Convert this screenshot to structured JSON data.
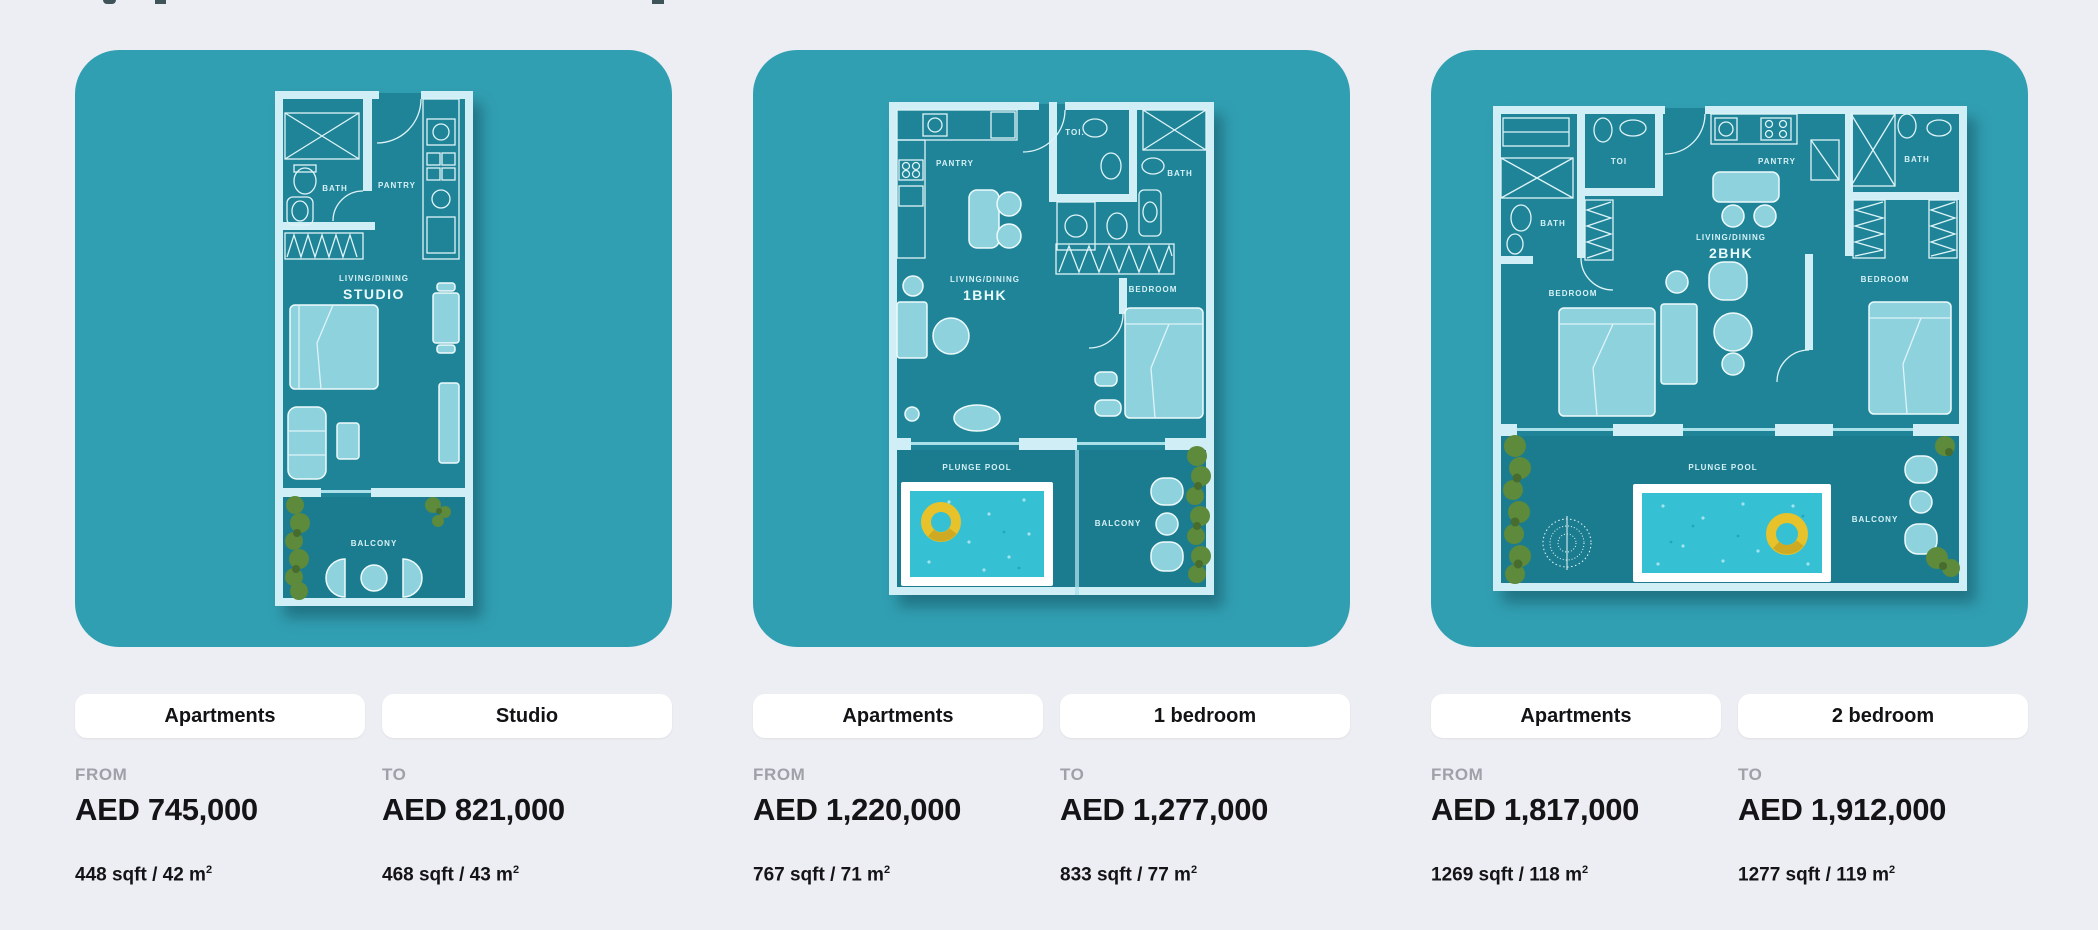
{
  "colors": {
    "page_bg": "#edeef3",
    "panel_teal": "#319fb2",
    "plan_interior": "#1f8498",
    "wall_light": "#cfeef6",
    "furniture_teal": "#8ed2de",
    "pool_water": "#35c0d4",
    "pool_frame": "#ffffff",
    "swim_ring_yellow": "#e8c22a",
    "hedge_green": "#5d8a3b",
    "pill_bg": "#ffffff",
    "label_gray": "#9fa0a8",
    "text_dark": "#141417"
  },
  "cards": [
    {
      "category": "Apartments",
      "bedrooms": "Studio",
      "from": {
        "label": "FROM",
        "price": "AED 745,000",
        "area": "448 sqft / 42 m",
        "area_sup": "2"
      },
      "to": {
        "label": "TO",
        "price": "AED 821,000",
        "area": "468 sqft / 43 m",
        "area_sup": "2"
      },
      "plan": {
        "bath": "BATH",
        "pantry": "PANTRY",
        "living": "LIVING/DINING",
        "unit": "STUDIO",
        "balcony": "BALCONY"
      }
    },
    {
      "category": "Apartments",
      "bedrooms": "1 bedroom",
      "from": {
        "label": "FROM",
        "price": "AED 1,220,000",
        "area": "767 sqft / 71 m",
        "area_sup": "2"
      },
      "to": {
        "label": "TO",
        "price": "AED 1,277,000",
        "area": "833 sqft / 77 m",
        "area_sup": "2"
      },
      "plan": {
        "pantry": "PANTRY",
        "toi": "TOI.",
        "bath": "BATH",
        "living": "LIVING/DINING",
        "unit": "1BHK",
        "bedroom": "BEDROOM",
        "pool": "PLUNGE POOL",
        "balcony": "BALCONY"
      }
    },
    {
      "category": "Apartments",
      "bedrooms": "2 bedroom",
      "from": {
        "label": "FROM",
        "price": "AED 1,817,000",
        "area": "1269 sqft / 118 m",
        "area_sup": "2"
      },
      "to": {
        "label": "TO",
        "price": "AED 1,912,000",
        "area": "1277 sqft / 119 m",
        "area_sup": "2"
      },
      "plan": {
        "bath_left": "BATH",
        "toi": "TOI",
        "pantry": "PANTRY",
        "bath_right": "BATH",
        "living": "LIVING/DINING",
        "unit": "2BHK",
        "bedroom_left": "BEDROOM",
        "bedroom_right": "BEDROOM",
        "pool": "PLUNGE POOL",
        "balcony": "BALCONY"
      }
    }
  ]
}
